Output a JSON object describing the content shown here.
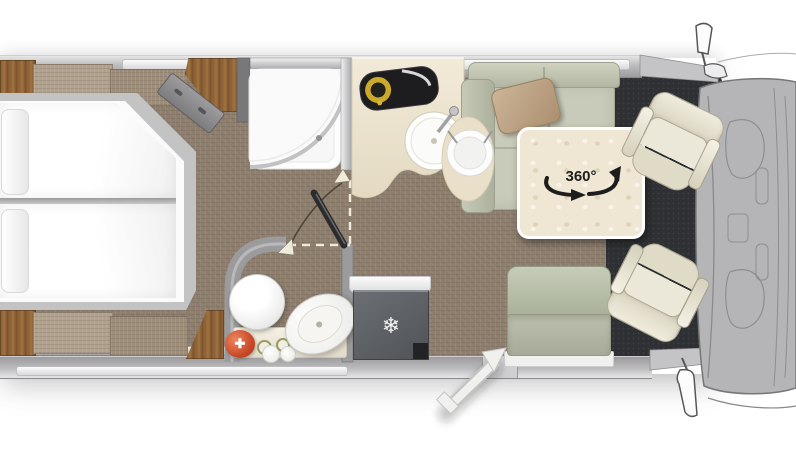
{
  "floorplan": {
    "type": "motorhome-top-view-floor-plan",
    "rotation_label": "360°",
    "icons": {
      "fridge_snowflake": "❄",
      "first_aid_cross": "✚"
    },
    "colors": {
      "carpet": "#8d7d6c",
      "wood": "#8a5f36",
      "wall_gray": "#bcbcbe",
      "counter_cream": "#ece2cc",
      "sofa_sage": "#c6c9b6",
      "bench_sage": "#bcc2ae",
      "seat_cream": "#ebe7d8",
      "cab_floor_dark": "#2f3033",
      "cab_body_gray": "#b5b5b7",
      "cooktop_black": "#1d1d1f",
      "burner_yellow": "#caa92c",
      "accent_red": "#c94a28",
      "white_fixture": "#fdfdfd"
    }
  }
}
